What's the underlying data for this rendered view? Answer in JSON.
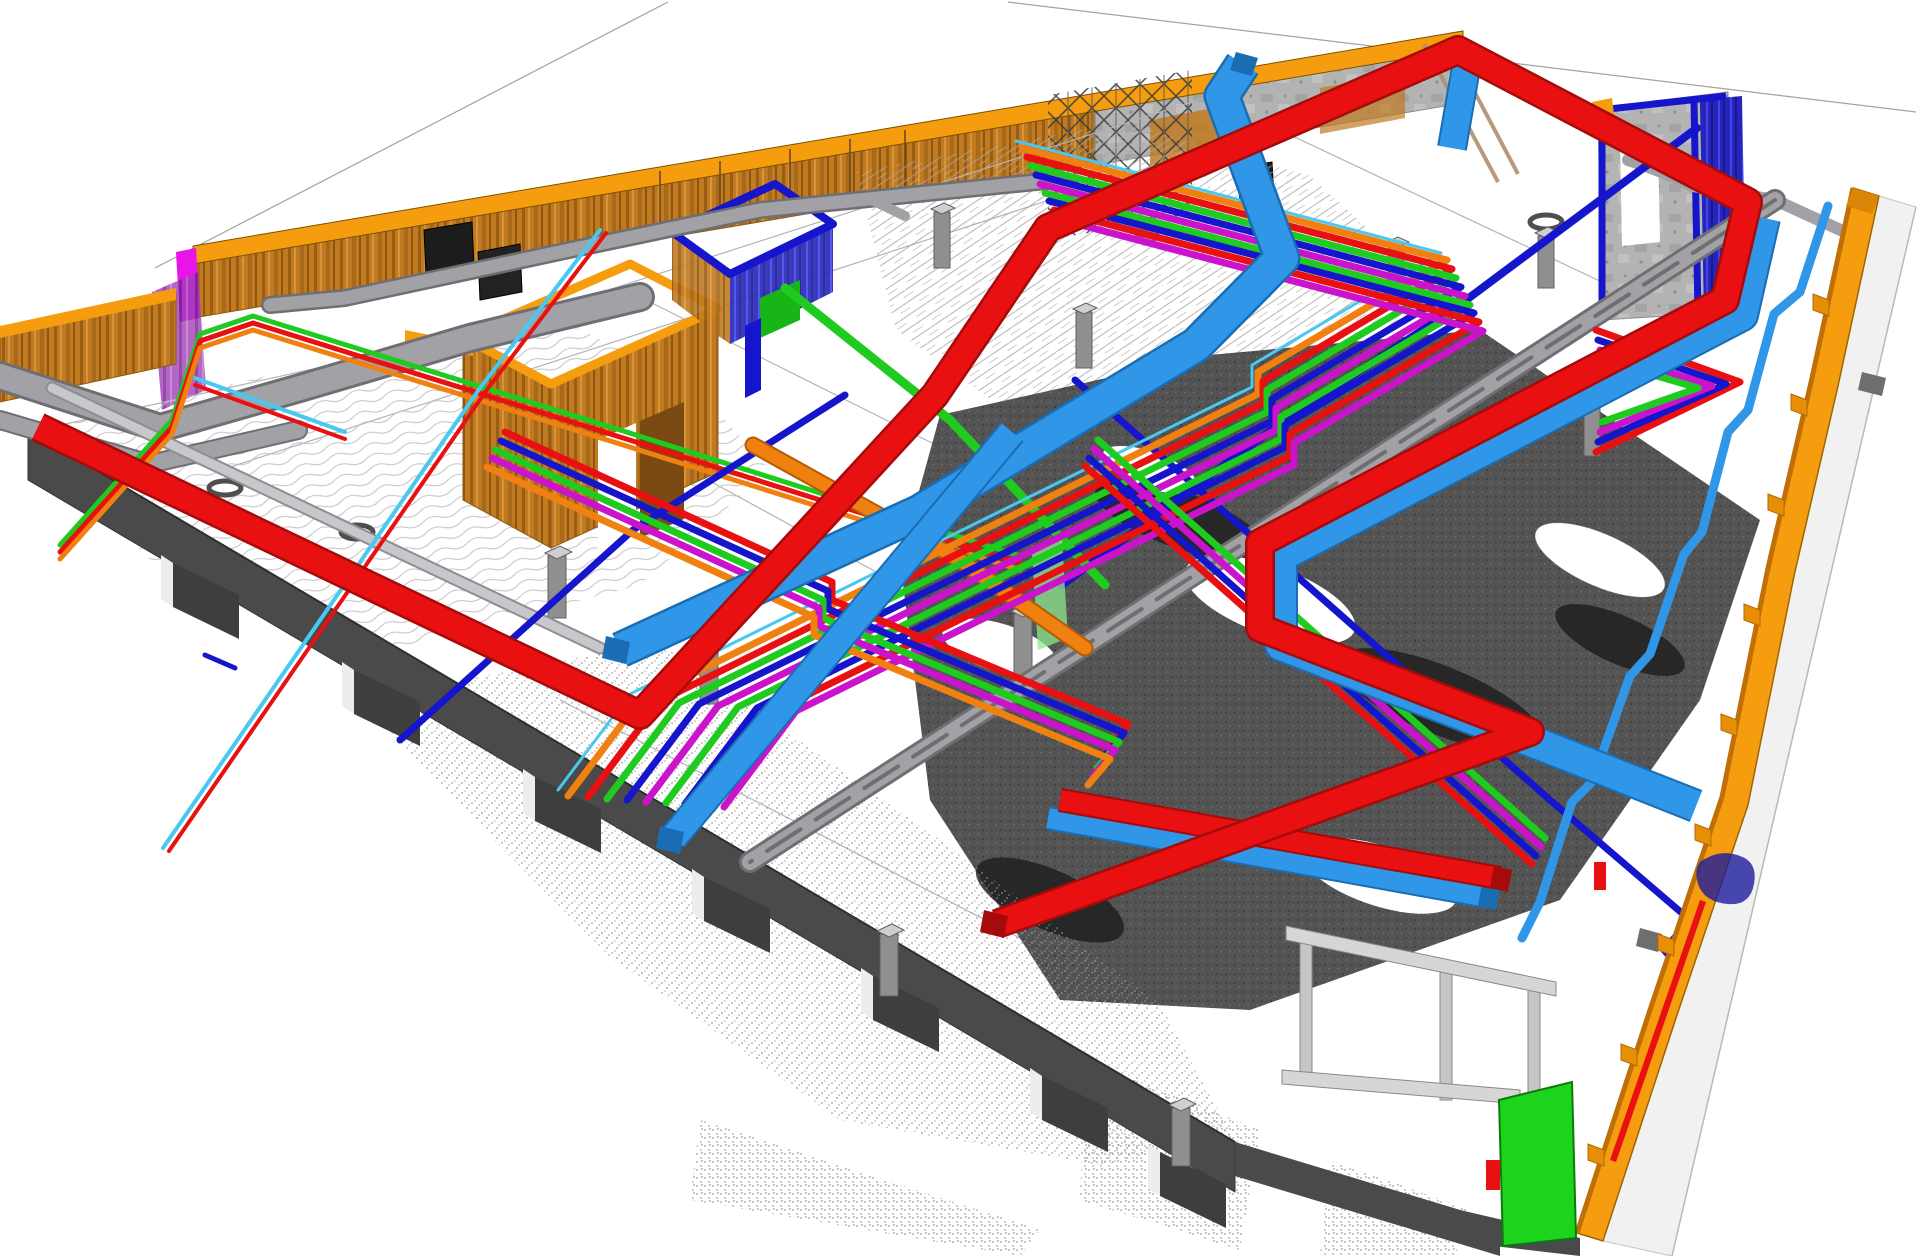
{
  "view": {
    "kind": "bim-pointcloud-coordination-3d-view",
    "projection": "isometric",
    "background": "#ffffff"
  },
  "colors": {
    "bg": "#ffffff",
    "cropLine": "#a3a3a3",
    "red": "#e81010",
    "redDark": "#a50b0b",
    "lightBlue": "#2f96e8",
    "lightBlueDark": "#1a6db3",
    "royalBlue": "#1515cc",
    "green": "#1ecb1e",
    "greenPanel": "#1dd41d",
    "greenPanelEdge": "#0d7a0d",
    "paleGreen": "#8fe88f",
    "magenta": "#cc13cc",
    "magentaBright": "#e815e8",
    "orangePipe": "#f08010",
    "orangePipeDark": "#b35c07",
    "wallOrange": "#f59d0e",
    "wallOrangeDeep": "#d98607",
    "wallOrangeShade": "#c06f06",
    "pilaster": "#e88e06",
    "grayDuct": "#a2a2a6",
    "grayDuctDark": "#6f6f73",
    "grayLight": "#c8c8cc",
    "grayLightDark": "#8e8e92",
    "slabDark": "#4a4a4a",
    "slabDarker": "#3e3e3e",
    "slabFace": "#ededed",
    "beamLight": "#d6d6d6",
    "beamEdge": "#8a8a8a",
    "column": "#8f8f8f",
    "columnEdge": "#606060",
    "columnCap": "#cfcfcf",
    "joint": "#b4b4b4",
    "cloudDarkBlob": "#1f1f1f",
    "navyScan": "#1c1c9e",
    "tan": "#b08f70",
    "brownDoor": "#7a4a12",
    "cyan": "#49c8f0",
    "panelBlack": "#1c1c1c",
    "ringGray": "#4f4f4f",
    "walkway": "#f1f1f1",
    "walkwayEdge": "#c4c4c4",
    "tabGray": "#6e6e6e",
    "blueRoomGreen": "#17b517"
  },
  "systems": [
    {
      "id": "red-duct-system",
      "colorRef": "red"
    },
    {
      "id": "light-blue-duct-system",
      "colorRef": "lightBlue"
    },
    {
      "id": "royal-blue-pipe-system",
      "colorRef": "royalBlue"
    },
    {
      "id": "green-pipe-system",
      "colorRef": "green"
    },
    {
      "id": "magenta-pipe-system",
      "colorRef": "magenta"
    },
    {
      "id": "orange-pipe-system",
      "colorRef": "orangePipe"
    },
    {
      "id": "gray-cable-tray-system",
      "colorRef": "grayDuct"
    },
    {
      "id": "structural-walls",
      "colorRef": "wallOrange"
    },
    {
      "id": "point-cloud-scan",
      "colorRef": "slabDark"
    }
  ]
}
